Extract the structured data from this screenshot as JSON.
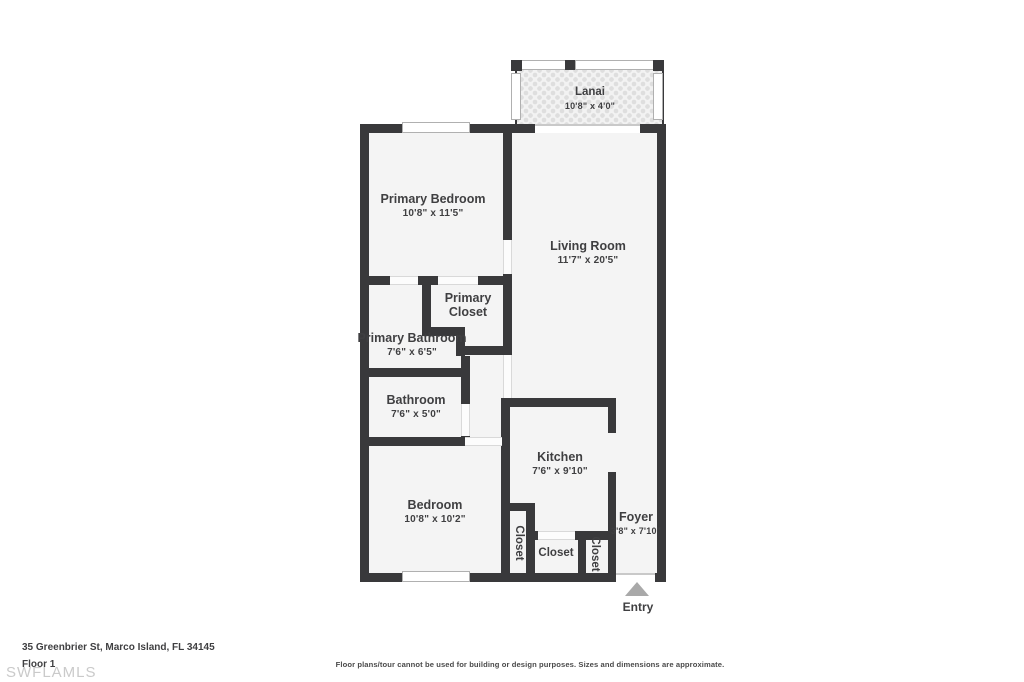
{
  "meta": {
    "address": "35 Greenbrier St, Marco Island, FL 34145",
    "floor_label": "Floor 1",
    "watermark": "SWFLAMLS",
    "disclaimer": "Floor plans/tour cannot be used for building or design purposes. Sizes and dimensions are approximate.",
    "entry_label": "Entry"
  },
  "colors": {
    "wall": "#39393b",
    "room_fill": "#f4f4f4",
    "text": "#3f3f41",
    "watermark": "#cacaca",
    "entry_arrow": "#a9a9a9",
    "window_border": "#b0b0b0",
    "door_line": "#d9d9d9",
    "lanai_fill": "#f2f2f2",
    "lanai_dot": "#dedede",
    "disclaimer": "#4a4a4a"
  },
  "rooms": {
    "lanai": {
      "name": "Lanai",
      "dims": "10'8\" x 4'0\""
    },
    "primary_bedroom": {
      "name": "Primary Bedroom",
      "dims": "10'8\" x 11'5\""
    },
    "living_room": {
      "name": "Living Room",
      "dims": "11'7\" x 20'5\""
    },
    "primary_closet": {
      "name": "Primary Closet",
      "dims": ""
    },
    "primary_bathroom": {
      "name": "Primary Bathroom",
      "dims": "7'6\" x 6'5\""
    },
    "bathroom": {
      "name": "Bathroom",
      "dims": "7'6\" x 5'0\""
    },
    "bedroom": {
      "name": "Bedroom",
      "dims": "10'8\" x 10'2\""
    },
    "kitchen": {
      "name": "Kitchen",
      "dims": "7'6\" x 9'10\""
    },
    "foyer": {
      "name": "Foyer",
      "dims": "3'8\" x 7'10\""
    },
    "closet_a": {
      "name": "Closet"
    },
    "closet_b": {
      "name": "Closet"
    },
    "closet_c": {
      "name": "Closet"
    }
  }
}
